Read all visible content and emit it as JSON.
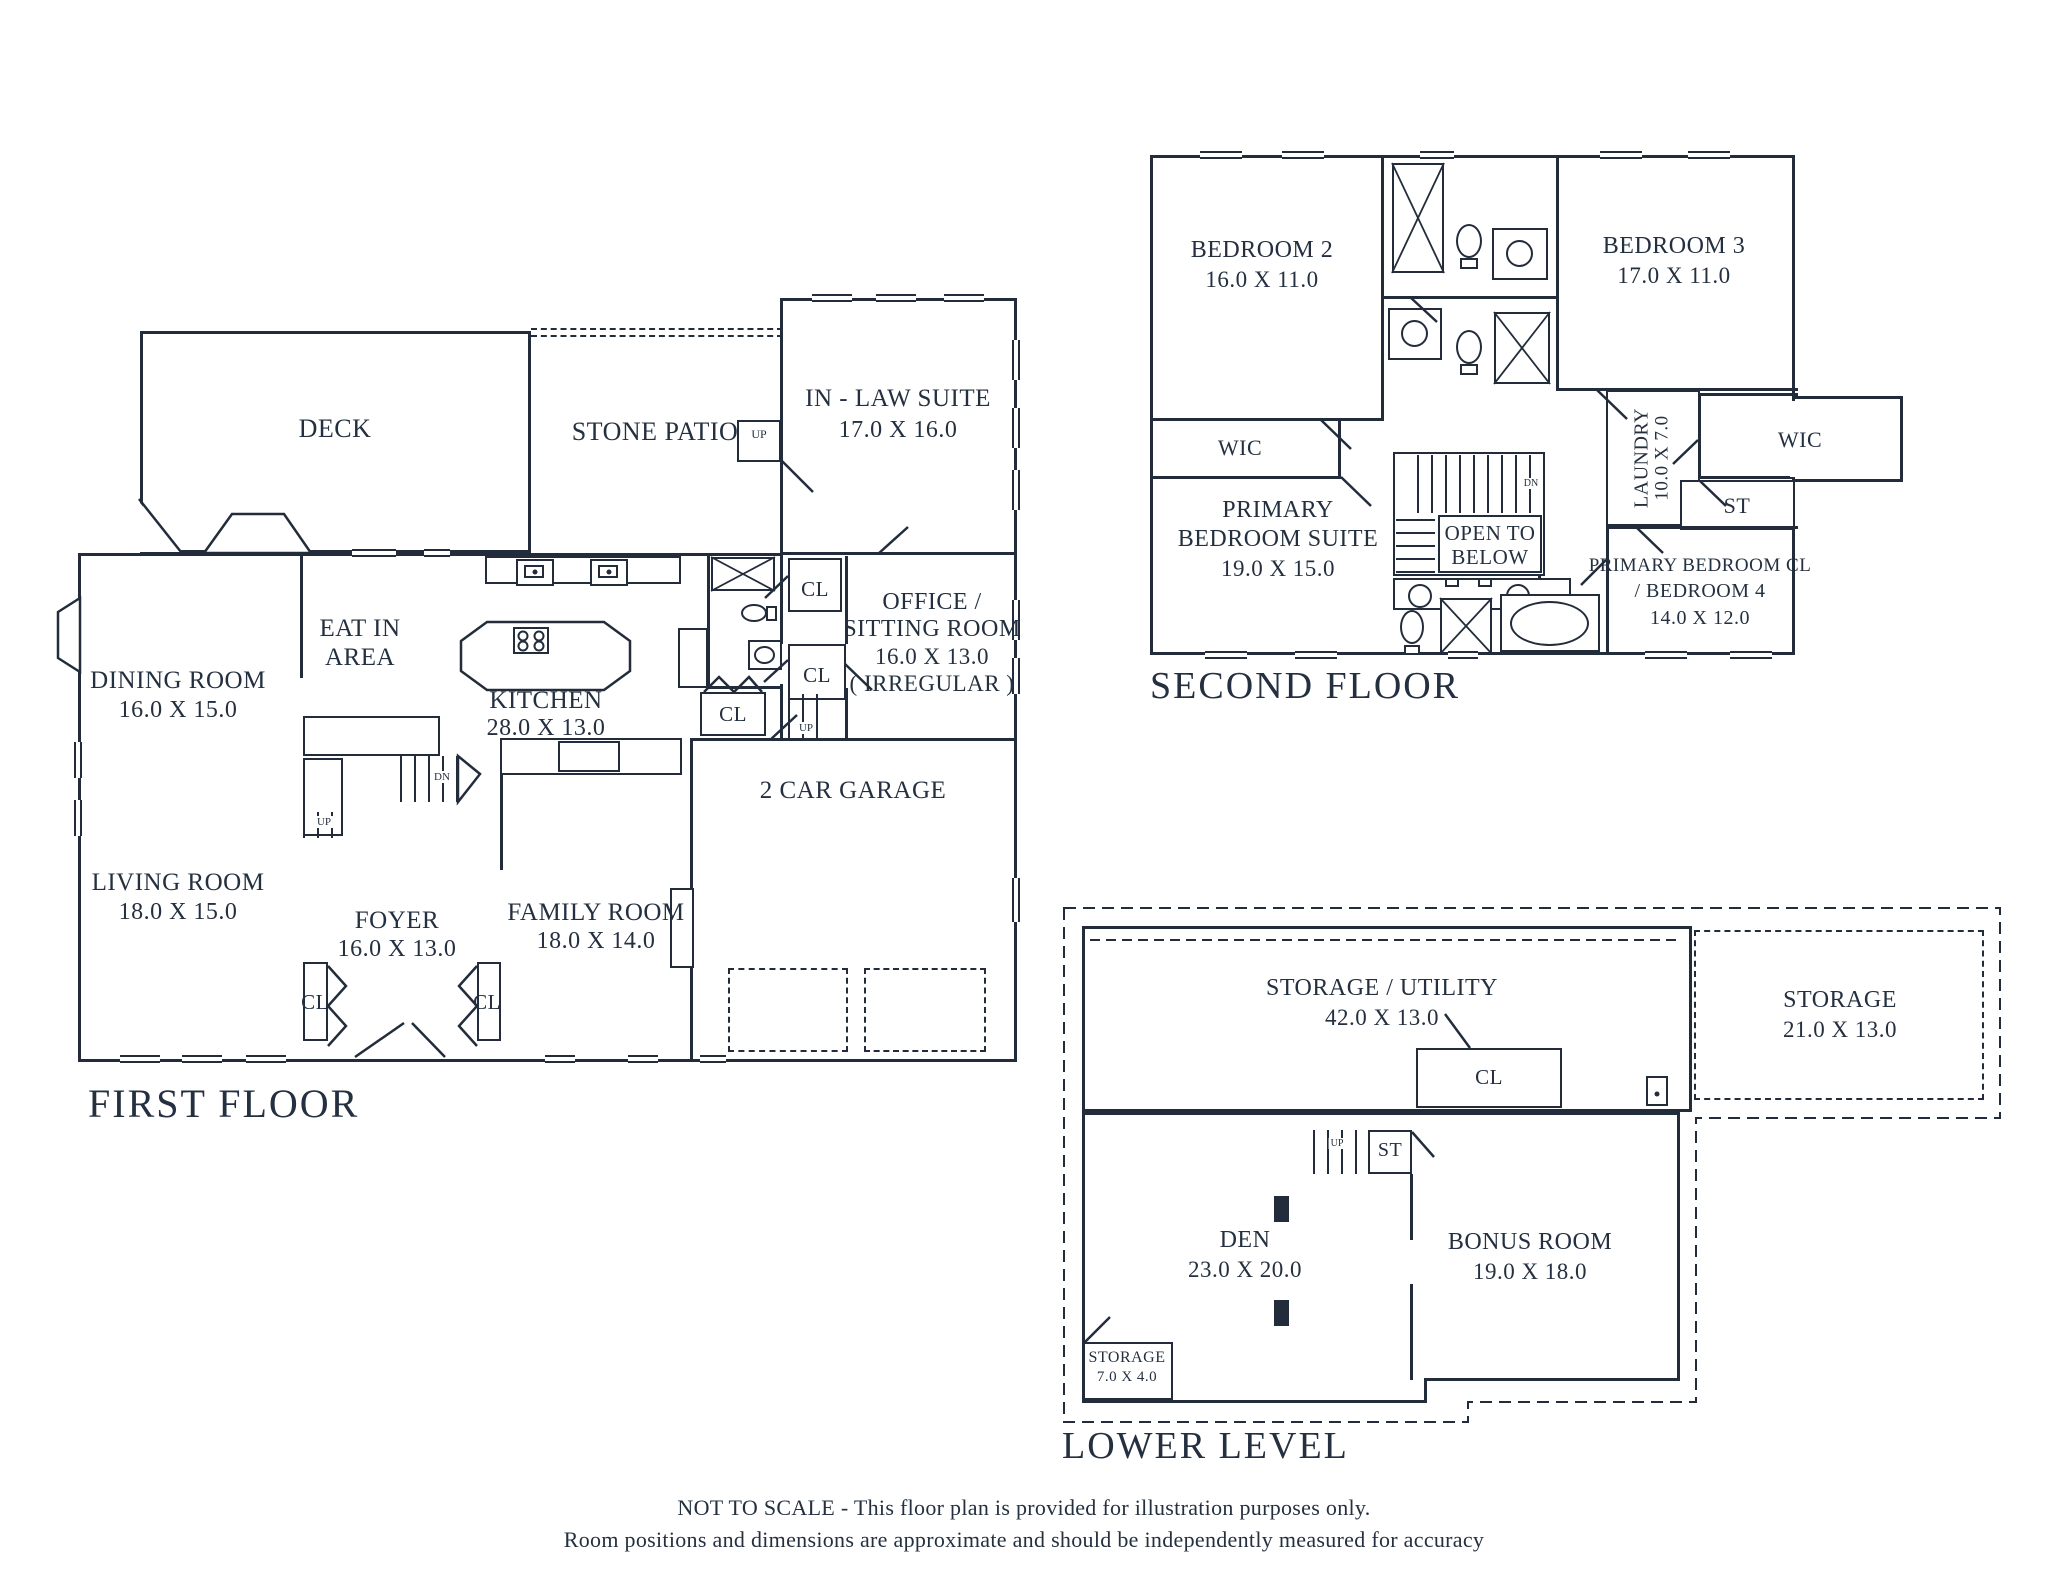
{
  "colors": {
    "line": "#222c3a",
    "text": "#243040",
    "background": "#ffffff"
  },
  "floors": {
    "first": {
      "title": "FIRST FLOOR",
      "deck": "DECK",
      "stone_patio": "STONE PATIO",
      "in_law_suite": {
        "name": "IN - LAW SUITE",
        "dims": "17.0 X 16.0"
      },
      "dining_room": {
        "name": "DINING ROOM",
        "dims": "16.0 X 15.0"
      },
      "eat_in_area": {
        "name": "EAT IN",
        "name2": "AREA"
      },
      "kitchen": {
        "name": "KITCHEN",
        "dims": "28.0 X 13.0"
      },
      "office": {
        "name": "OFFICE /",
        "name2": "SITTING ROOM",
        "dims": "16.0 X 13.0",
        "note": "( IRREGULAR )"
      },
      "living_room": {
        "name": "LIVING ROOM",
        "dims": "18.0 X 15.0"
      },
      "foyer": {
        "name": "FOYER",
        "dims": "16.0 X 13.0"
      },
      "family_room": {
        "name": "FAMILY ROOM",
        "dims": "18.0 X 14.0"
      },
      "garage": "2 CAR GARAGE",
      "closet": "CL",
      "up": "UP",
      "down": "DN"
    },
    "second": {
      "title": "SECOND FLOOR",
      "bedroom2": {
        "name": "BEDROOM 2",
        "dims": "16.0 X 11.0"
      },
      "bedroom3": {
        "name": "BEDROOM 3",
        "dims": "17.0 X 11.0"
      },
      "wic": "WIC",
      "laundry": {
        "name": "LAUNDRY",
        "dims": "10.0 X 7.0"
      },
      "stairs_closet": "ST",
      "open_to_below": {
        "line1": "OPEN TO",
        "line2": "BELOW"
      },
      "primary_suite": {
        "line1": "PRIMARY",
        "line2": "BEDROOM SUITE",
        "dims": "19.0 X 15.0"
      },
      "primary_cl": {
        "line1": "PRIMARY BEDROOM CL",
        "line2": "/ BEDROOM 4",
        "dims": "14.0 X 12.0"
      },
      "down": "DN"
    },
    "lower": {
      "title": "LOWER LEVEL",
      "storage_utility": {
        "name": "STORAGE / UTILITY",
        "dims": "42.0 X 13.0"
      },
      "storage": {
        "name": "STORAGE",
        "dims": "21.0 X 13.0"
      },
      "storage_small": {
        "name": "STORAGE",
        "dims": "7.0 X 4.0"
      },
      "den": {
        "name": "DEN",
        "dims": "23.0 X 20.0"
      },
      "bonus_room": {
        "name": "BONUS ROOM",
        "dims": "19.0 X 18.0"
      },
      "closet": "CL",
      "stairs_closet": "ST",
      "up": "UP"
    }
  },
  "footer": {
    "line1": "NOT TO SCALE - This floor plan is provided for illustration purposes only.",
    "line2": "Room positions and dimensions are approximate and should be independently measured for accuracy"
  }
}
